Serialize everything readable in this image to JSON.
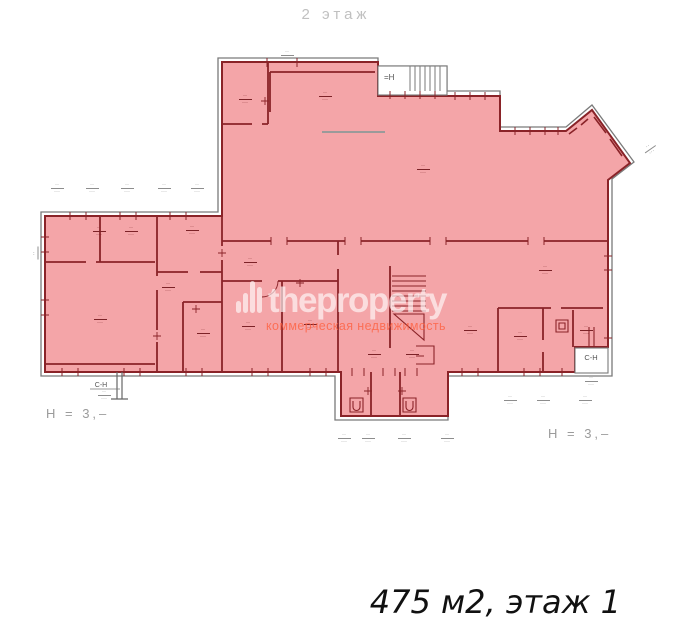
{
  "title": {
    "text": "2 этаж"
  },
  "caption": {
    "text": "475 м2, этаж 1"
  },
  "watermark": {
    "brand": "theproperty",
    "tagline": "коммерческая недвижимость",
    "brand_color": "#ffffff",
    "tagline_color": "#ff5c3a"
  },
  "plan": {
    "colors": {
      "highlight": "#f4a5a8",
      "wall": "#8a2328",
      "outline": "#7a7a7a",
      "label": "#7c2227",
      "dim": "#8d8d8d"
    },
    "texts": {
      "stair_top": "=Н",
      "service_left": "С-Н",
      "service_right": "С-Н",
      "height_left": "Н = 3,–",
      "height_right": "Н = 3,–"
    },
    "glyphs": {
      "top": "··",
      "bottom": "···"
    },
    "room_labels": [
      {
        "x": 245,
        "y": 94
      },
      {
        "x": 325,
        "y": 91
      },
      {
        "x": 423,
        "y": 164
      },
      {
        "x": 99,
        "y": 226
      },
      {
        "x": 131,
        "y": 226
      },
      {
        "x": 192,
        "y": 225
      },
      {
        "x": 100,
        "y": 314
      },
      {
        "x": 168,
        "y": 282
      },
      {
        "x": 203,
        "y": 328
      },
      {
        "x": 250,
        "y": 257
      },
      {
        "x": 248,
        "y": 321
      },
      {
        "x": 310,
        "y": 319
      },
      {
        "x": 545,
        "y": 265
      },
      {
        "x": 470,
        "y": 325
      },
      {
        "x": 520,
        "y": 331
      },
      {
        "x": 586,
        "y": 325
      },
      {
        "x": 374,
        "y": 349
      },
      {
        "x": 412,
        "y": 349
      }
    ],
    "dim_labels": [
      {
        "x": 57,
        "y": 183
      },
      {
        "x": 92,
        "y": 183
      },
      {
        "x": 127,
        "y": 183
      },
      {
        "x": 164,
        "y": 183
      },
      {
        "x": 197,
        "y": 183
      },
      {
        "x": 287,
        "y": 50
      },
      {
        "x": 510,
        "y": 395
      },
      {
        "x": 543,
        "y": 395
      },
      {
        "x": 585,
        "y": 395
      },
      {
        "x": 344,
        "y": 433
      },
      {
        "x": 368,
        "y": 433
      },
      {
        "x": 404,
        "y": 433
      },
      {
        "x": 447,
        "y": 433
      },
      {
        "x": 38,
        "y": 248,
        "rot": -90
      },
      {
        "x": 650,
        "y": 144,
        "rot": -35
      },
      {
        "x": 591,
        "y": 376
      },
      {
        "x": 104,
        "y": 390
      }
    ]
  }
}
